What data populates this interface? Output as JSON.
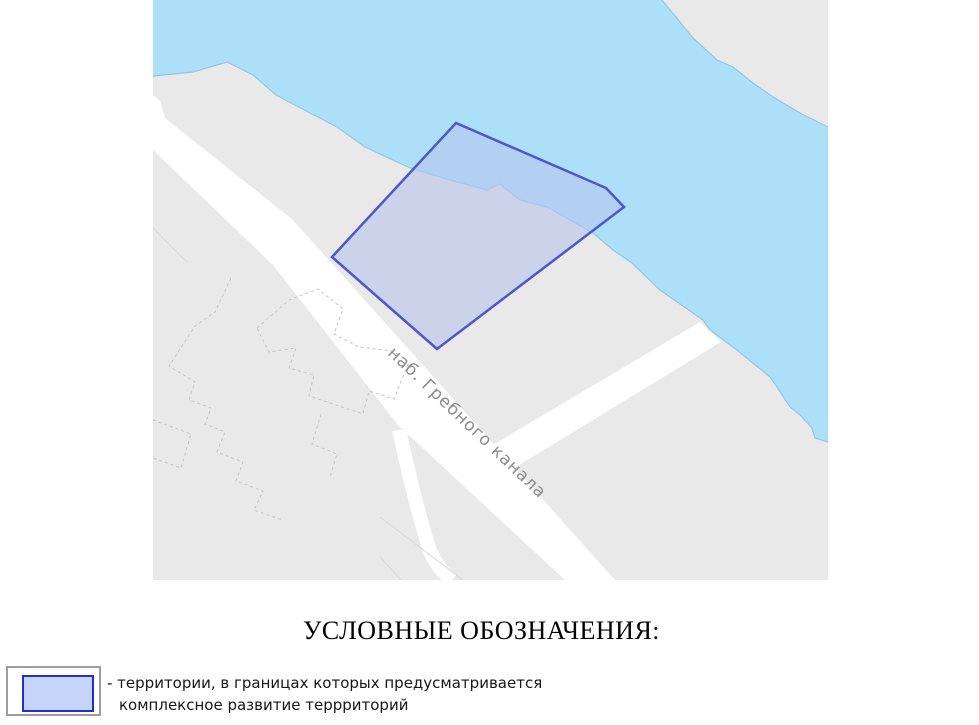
{
  "map": {
    "street_label": "наб. Гребного канала",
    "colors": {
      "water": "#abe0f8",
      "shore_line": "#92c5e6",
      "land": "#e9e9e9",
      "road": "#ffffff",
      "building_dash": "#c2c2c2",
      "parcel_line": "#d6d6d6",
      "highlight_fill": "#b7c4ec",
      "highlight_border": "#4f55cc",
      "street_label_color": "#8c8c8c"
    }
  },
  "legend": {
    "heading": "УСЛОВНЫЕ ОБОЗНАЧЕНИЯ:",
    "items": [
      {
        "line1": "- территории, в границах которых предусматривается",
        "line2": "комплексное развитие террриторий",
        "swatch_fill": "#c5d4f8",
        "swatch_border": "#1f2ed8",
        "swatch_outer_border": "#9e9e9e"
      }
    ]
  }
}
